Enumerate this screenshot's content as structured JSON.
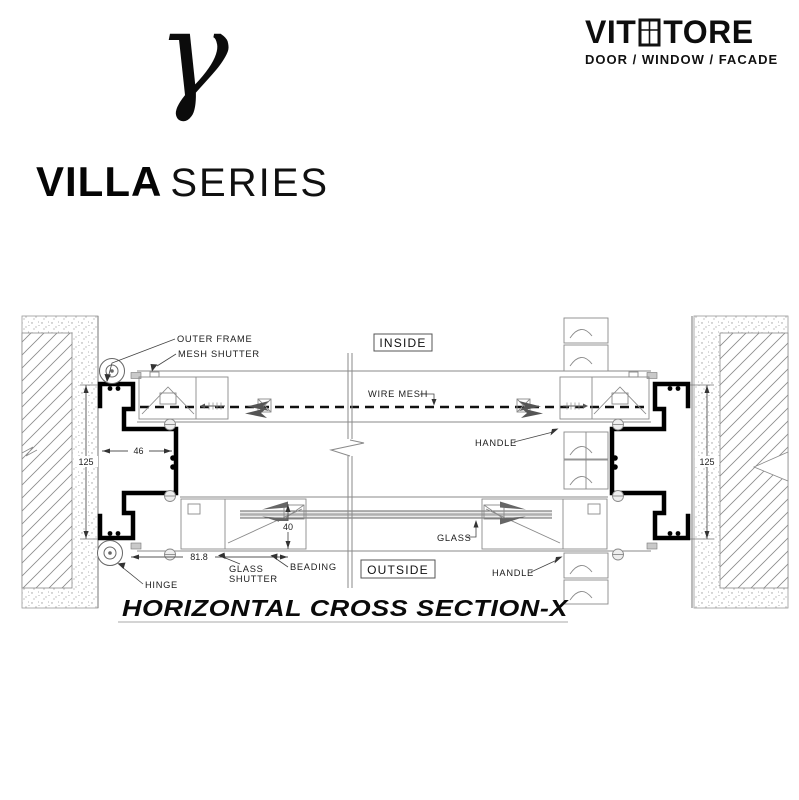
{
  "brand": {
    "monogram": "γ",
    "wordmark_v": "V",
    "wordmark_it": "IT",
    "wordmark_tore": "TORE",
    "tagline": "DOOR / WINDOW / FACADE",
    "series_name": "VILLA",
    "series_suffix": "SERIES"
  },
  "drawing": {
    "title": "HORIZONTAL CROSS SECTION-X",
    "zone_inside": "INSIDE",
    "zone_outside": "OUTSIDE",
    "callouts": {
      "outer_frame": "OUTER FRAME",
      "mesh_shutter": "MESH SHUTTER",
      "wire_mesh": "WIRE MESH",
      "handle_top": "HANDLE",
      "glass": "GLASS",
      "handle_bottom": "HANDLE",
      "glass_shutter_1": "GLASS",
      "glass_shutter_2": "SHUTTER",
      "beading": "BEADING",
      "hinge": "HINGE"
    },
    "dimensions": {
      "left_wall_height": "125",
      "right_wall_height": "125",
      "frame_width": "46",
      "shutter_width": "81.8",
      "glass_offset": "40"
    }
  }
}
